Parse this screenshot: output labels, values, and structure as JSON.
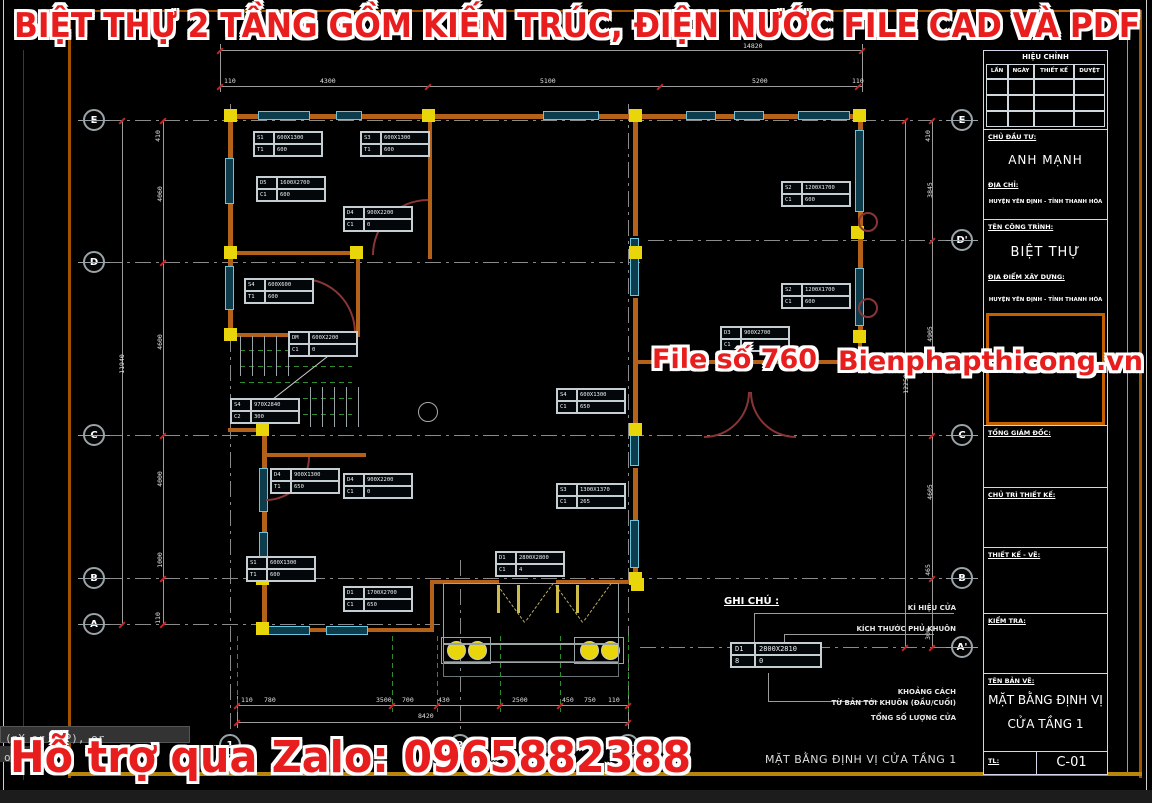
{
  "header_title": "BIỆT THỰ 2 TẦNG GỒM KIẾN TRÚC, ĐIỆN NƯỚC FILE CAD VÀ PDF",
  "watermarks": {
    "file_no": "File số 760",
    "site": "Bienphapthicong.vn",
    "zalo": "Hỗ trợ qua Zalo: 0965882388"
  },
  "command_line": {
    "line1": "(nX or nXP), or",
    "line2": "ow"
  },
  "plan_caption": "MẶT BẰNG ĐỊNH VỊ CỬA TẦNG 1",
  "title_block": {
    "revision_title": "HIỆU CHỈNH",
    "rev_cols": [
      "LẦN",
      "NGÀY",
      "THIẾT KẾ",
      "DUYỆT"
    ],
    "investor_label": "CHỦ ĐẦU TƯ:",
    "investor": "ANH MẠNH",
    "address_label": "ĐỊA CHỈ:",
    "address": "HUYỆN YÊN ĐỊNH - TỈNH THANH HÓA",
    "project_label": "TÊN CÔNG TRÌNH:",
    "project": "BIỆT THỰ",
    "location_label": "ĐỊA ĐIỂM XÂY DỰNG:",
    "location": "HUYỆN YÊN ĐỊNH - TỈNH THANH HÓA",
    "director_label": "TỔNG GIÁM ĐỐC:",
    "lead_label": "CHỦ TRÌ THIẾT KẾ:",
    "design_label": "THIẾT KẾ - VẼ:",
    "check_label": "KIỂM TRA:",
    "drawing_label": "TÊN BẢN VẼ:",
    "drawing_name_1": "MẶT BẰNG ĐỊNH VỊ",
    "drawing_name_2": "CỬA TẦNG 1",
    "scale_label": "TL:",
    "sheet_no": "C-01"
  },
  "legend": {
    "title": "GHI CHÚ :",
    "labels": [
      "KÍ HIỆU CỬA",
      "KÍCH THƯỚC PHỦ KHUÔN",
      "KHOẢNG CÁCH",
      "TỪ BẢN TỚI KHUÔN (ĐẦU/CUỐI)",
      "TỔNG SỐ LƯỢNG CỬA"
    ],
    "tag": {
      "c1": "D1",
      "c2": "2800X2810",
      "c3": "8",
      "c4": "0"
    }
  },
  "plan": {
    "grid_bubbles": [
      {
        "label": "E",
        "x": 94,
        "y": 120
      },
      {
        "label": "D",
        "x": 94,
        "y": 262
      },
      {
        "label": "C",
        "x": 94,
        "y": 435
      },
      {
        "label": "B",
        "x": 94,
        "y": 578
      },
      {
        "label": "A",
        "x": 94,
        "y": 624
      },
      {
        "label": "E",
        "x": 962,
        "y": 120
      },
      {
        "label": "D'",
        "x": 962,
        "y": 240
      },
      {
        "label": "C",
        "x": 962,
        "y": 435
      },
      {
        "label": "B",
        "x": 962,
        "y": 578
      },
      {
        "label": "A'",
        "x": 962,
        "y": 647
      },
      {
        "label": "1",
        "x": 230,
        "y": 745
      },
      {
        "label": "2",
        "x": 460,
        "y": 745
      },
      {
        "label": "3",
        "x": 628,
        "y": 745
      }
    ],
    "dim_labels": [
      {
        "t": "14820",
        "x": 743,
        "y": 42
      },
      {
        "t": "110",
        "x": 224,
        "y": 77
      },
      {
        "t": "4300",
        "x": 320,
        "y": 77
      },
      {
        "t": "5100",
        "x": 540,
        "y": 77
      },
      {
        "t": "5200",
        "x": 752,
        "y": 77
      },
      {
        "t": "110",
        "x": 852,
        "y": 77
      },
      {
        "t": "8420",
        "x": 418,
        "y": 712
      },
      {
        "t": "110",
        "x": 241,
        "y": 696
      },
      {
        "t": "780",
        "x": 264,
        "y": 696
      },
      {
        "t": "3500",
        "x": 376,
        "y": 696
      },
      {
        "t": "700",
        "x": 402,
        "y": 696
      },
      {
        "t": "430",
        "x": 438,
        "y": 696
      },
      {
        "t": "2500",
        "x": 512,
        "y": 696
      },
      {
        "t": "450",
        "x": 562,
        "y": 696
      },
      {
        "t": "750",
        "x": 584,
        "y": 696
      },
      {
        "t": "110",
        "x": 608,
        "y": 696
      },
      {
        "t": "11940",
        "x": 112,
        "y": 360,
        "rot": 1
      },
      {
        "t": "410",
        "x": 152,
        "y": 132,
        "rot": 1
      },
      {
        "t": "4060",
        "x": 152,
        "y": 190,
        "rot": 1
      },
      {
        "t": "4600",
        "x": 152,
        "y": 338,
        "rot": 1
      },
      {
        "t": "4000",
        "x": 152,
        "y": 475,
        "rot": 1
      },
      {
        "t": "1000",
        "x": 152,
        "y": 556,
        "rot": 1
      },
      {
        "t": "110",
        "x": 152,
        "y": 614,
        "rot": 1
      },
      {
        "t": "12250",
        "x": 896,
        "y": 380,
        "rot": 1
      },
      {
        "t": "410",
        "x": 922,
        "y": 132,
        "rot": 1
      },
      {
        "t": "3845",
        "x": 922,
        "y": 186,
        "rot": 1
      },
      {
        "t": "4905",
        "x": 922,
        "y": 330,
        "rot": 1
      },
      {
        "t": "4605",
        "x": 922,
        "y": 488,
        "rot": 1
      },
      {
        "t": "465",
        "x": 922,
        "y": 566,
        "rot": 1
      },
      {
        "t": "300",
        "x": 922,
        "y": 630,
        "rot": 1
      }
    ],
    "tags": [
      {
        "x": 253,
        "y": 131,
        "c1": "S1",
        "c2": "600X1300",
        "c3": "T1",
        "c4": "600"
      },
      {
        "x": 360,
        "y": 131,
        "c1": "S3",
        "c2": "600X1300",
        "c3": "T1",
        "c4": "600"
      },
      {
        "x": 256,
        "y": 176,
        "c1": "D5",
        "c2": "1600X2700",
        "c3": "C1",
        "c4": "600"
      },
      {
        "x": 343,
        "y": 206,
        "c1": "D4",
        "c2": "900X2200",
        "c3": "C1",
        "c4": "0"
      },
      {
        "x": 244,
        "y": 278,
        "c1": "S4",
        "c2": "600X600",
        "c3": "T1",
        "c4": "600"
      },
      {
        "x": 288,
        "y": 331,
        "c1": "DM",
        "c2": "600X2200",
        "c3": "C1",
        "c4": "0"
      },
      {
        "x": 230,
        "y": 398,
        "c1": "S4",
        "c2": "970X2840",
        "c3": "C2",
        "c4": "300"
      },
      {
        "x": 270,
        "y": 468,
        "c1": "D4",
        "c2": "900X1300",
        "c3": "T1",
        "c4": "650"
      },
      {
        "x": 343,
        "y": 473,
        "c1": "D4",
        "c2": "900X2200",
        "c3": "C1",
        "c4": "0"
      },
      {
        "x": 246,
        "y": 556,
        "c1": "S1",
        "c2": "600X1300",
        "c3": "T1",
        "c4": "600"
      },
      {
        "x": 343,
        "y": 586,
        "c1": "D1",
        "c2": "1700X2700",
        "c3": "C1",
        "c4": "650"
      },
      {
        "x": 495,
        "y": 551,
        "c1": "D1",
        "c2": "2800X2800",
        "c3": "C1",
        "c4": "4"
      },
      {
        "x": 556,
        "y": 388,
        "c1": "S4",
        "c2": "600X1300",
        "c3": "C1",
        "c4": "650"
      },
      {
        "x": 556,
        "y": 483,
        "c1": "S3",
        "c2": "1300X1370",
        "c3": "C1",
        "c4": "265"
      },
      {
        "x": 781,
        "y": 181,
        "c1": "S2",
        "c2": "1200X1700",
        "c3": "C1",
        "c4": "600"
      },
      {
        "x": 781,
        "y": 283,
        "c1": "S2",
        "c2": "1200X1700",
        "c3": "C1",
        "c4": "600"
      },
      {
        "x": 720,
        "y": 326,
        "c1": "D3",
        "c2": "900X2700",
        "c3": "C1",
        "c4": "0"
      }
    ]
  }
}
